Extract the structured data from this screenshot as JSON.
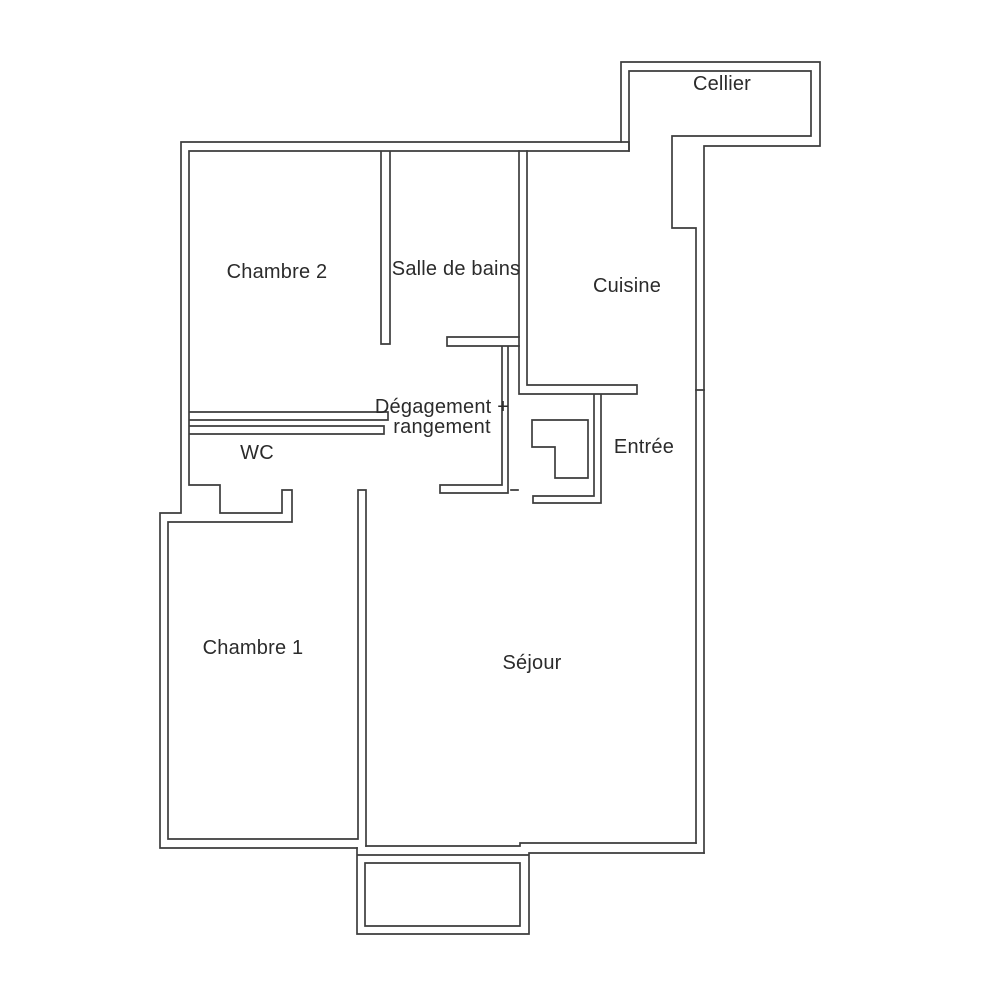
{
  "plan": {
    "kind": "apartment-floor-plan",
    "background_color": "#ffffff",
    "wall_line_color": "#3d3d3d",
    "label_text_color": "#2b2b2b"
  },
  "rooms": {
    "cellier": {
      "label": "Cellier"
    },
    "chambre2": {
      "label": "Chambre 2"
    },
    "salle_de_bains": {
      "label": "Salle de bains"
    },
    "cuisine": {
      "label": "Cuisine"
    },
    "degagement": {
      "lines": [
        "Dégagement +",
        "rangement"
      ]
    },
    "wc": {
      "label": "WC"
    },
    "entree": {
      "label": "Entrée"
    },
    "chambre1": {
      "label": "Chambre 1"
    },
    "sejour": {
      "label": "Séjour"
    }
  }
}
